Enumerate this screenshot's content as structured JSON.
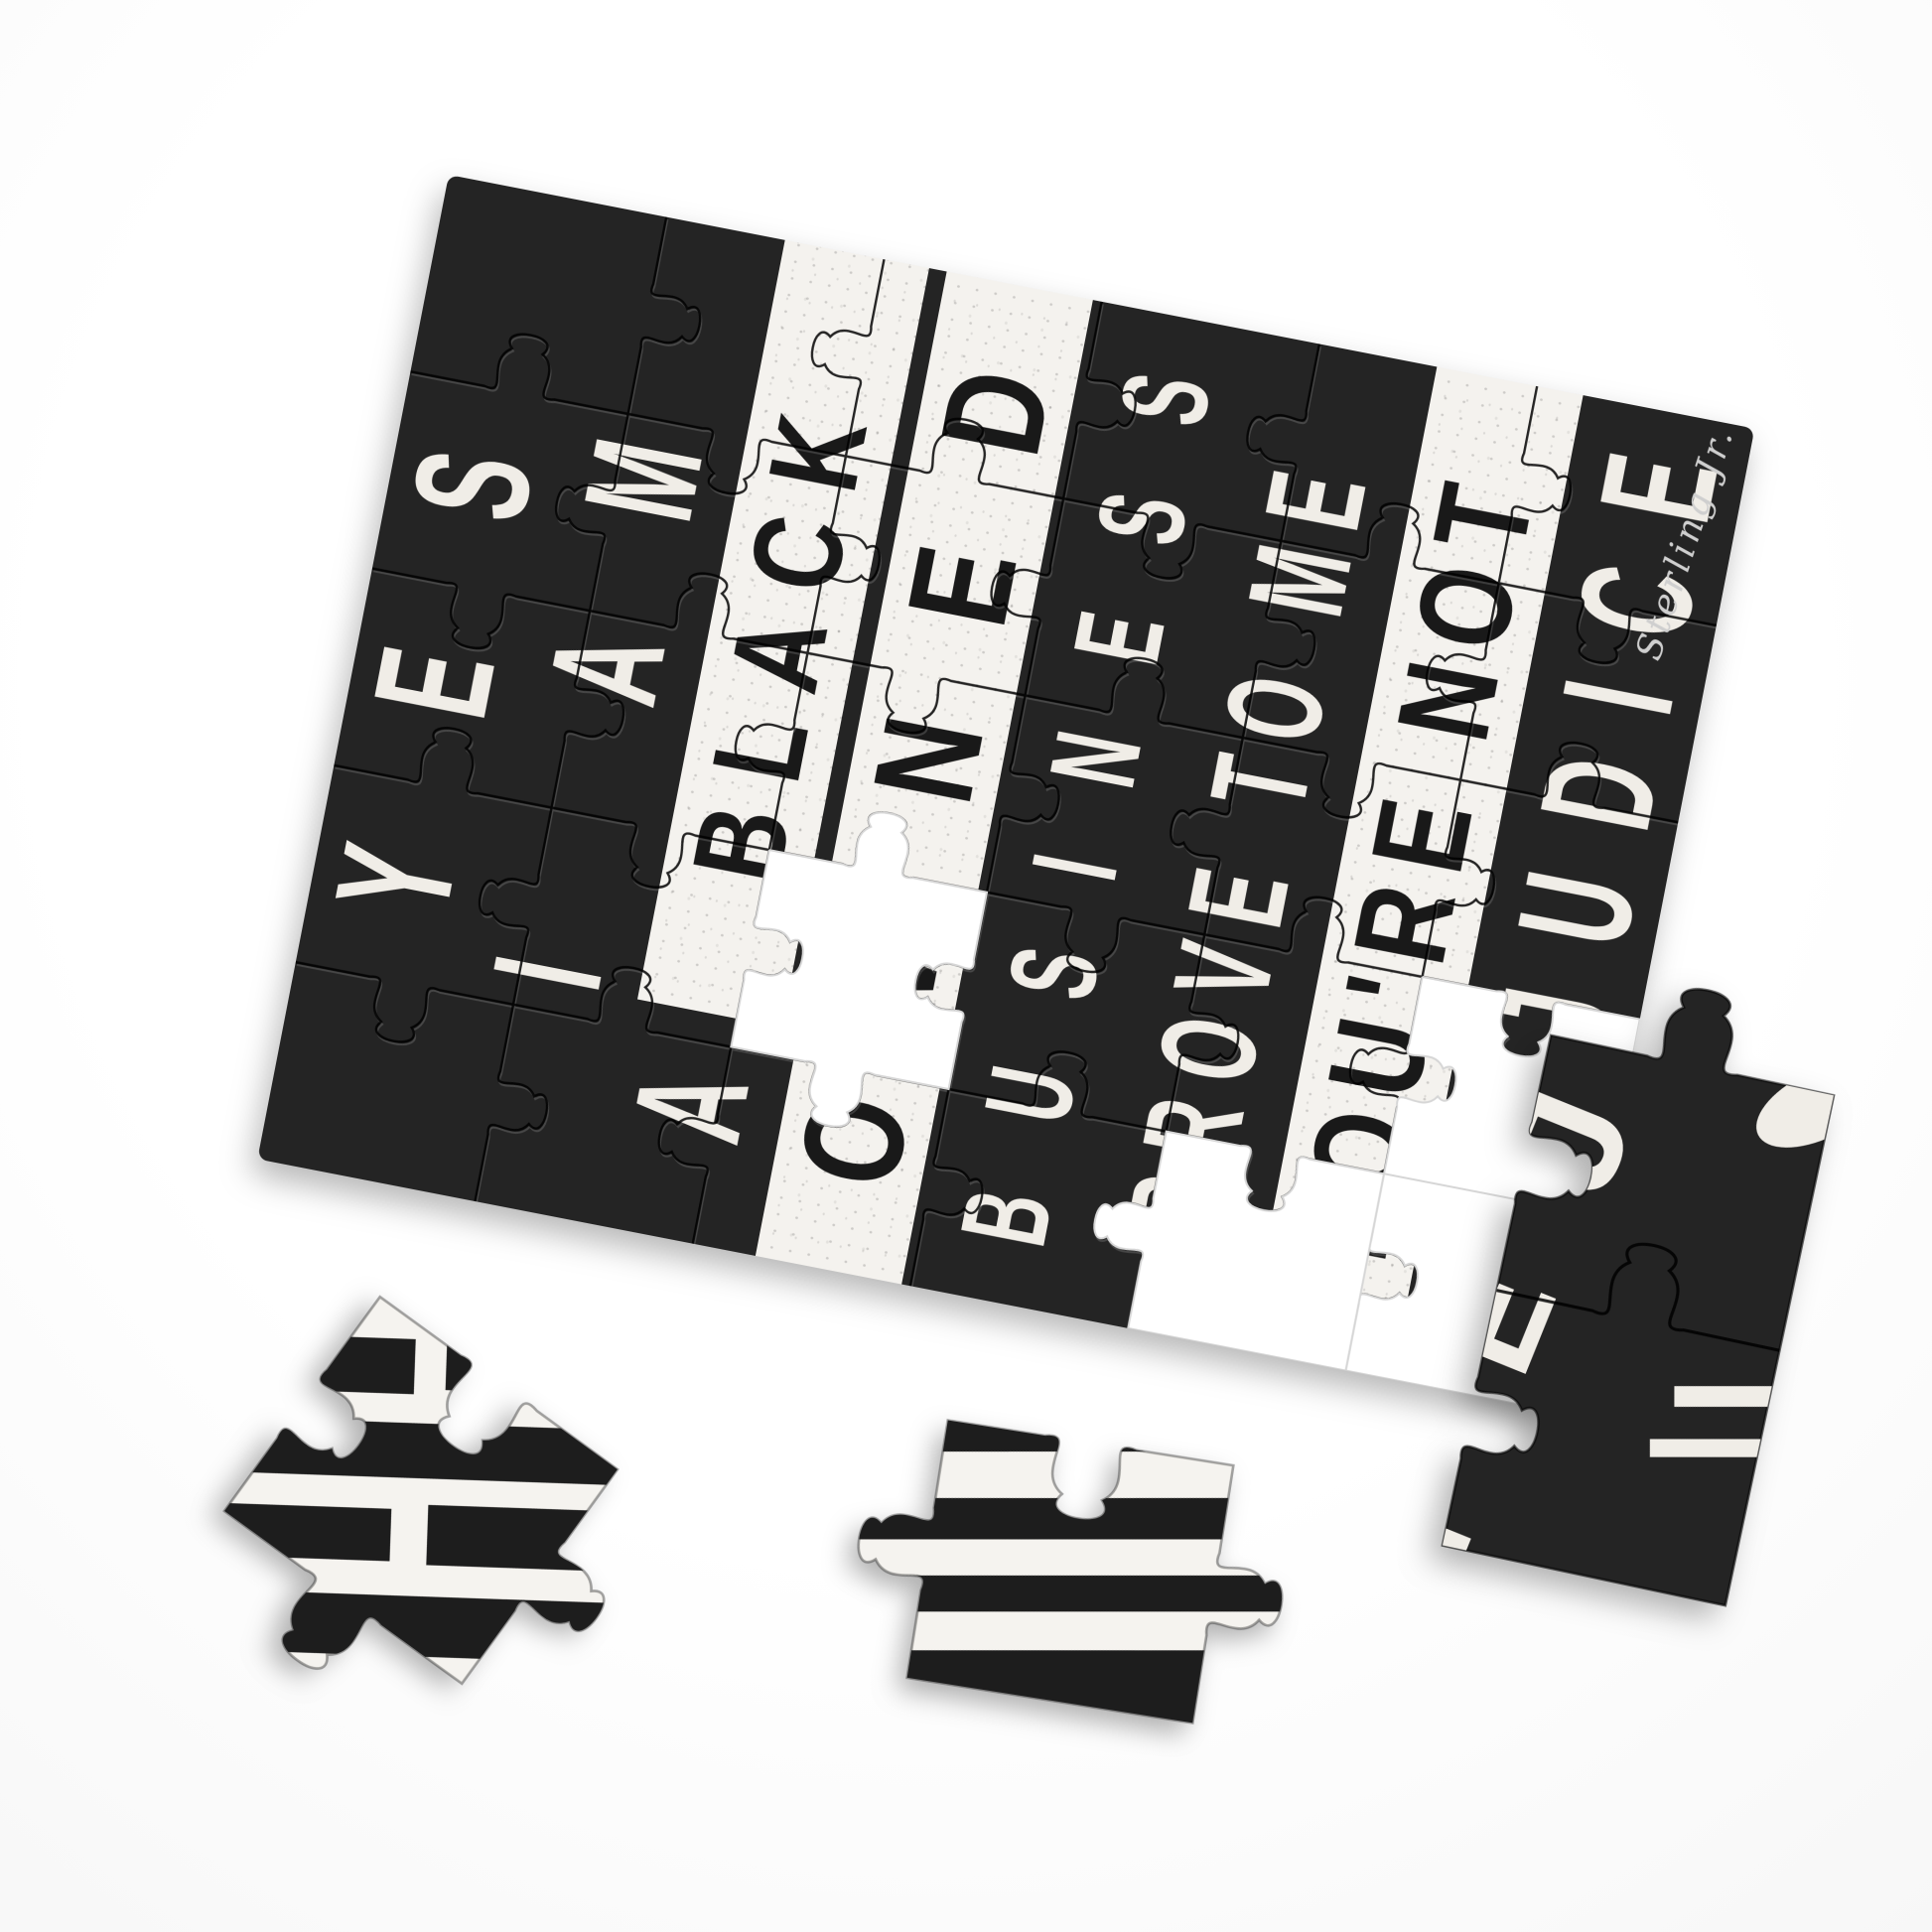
{
  "puzzle": {
    "lines": [
      {
        "text": "YES",
        "style": "light"
      },
      {
        "text": "I AM",
        "style": "light"
      },
      {
        "word1": "A",
        "word2": "BLACK",
        "style": "mixed"
      },
      {
        "text": "OWNED",
        "style": "band"
      },
      {
        "text": "BUSINESS",
        "style": "light"
      },
      {
        "text": "PROVE TO ME",
        "style": "light"
      },
      {
        "text": "YOU'RE NOT",
        "style": "band"
      },
      {
        "text": "PREJUDICE",
        "style": "light"
      }
    ],
    "signature": "Sterling Jr.",
    "grid": {
      "cols": 6,
      "rows": 5
    },
    "missing_piece_count": 4,
    "colors": {
      "board": "#242424",
      "band": "#f4f2ee",
      "ink": "#f0ede7",
      "band_ink": "#191919",
      "surface": "#ffffff"
    }
  },
  "loose_pieces": {
    "right_letters": [
      "J",
      "E",
      "P"
    ]
  }
}
